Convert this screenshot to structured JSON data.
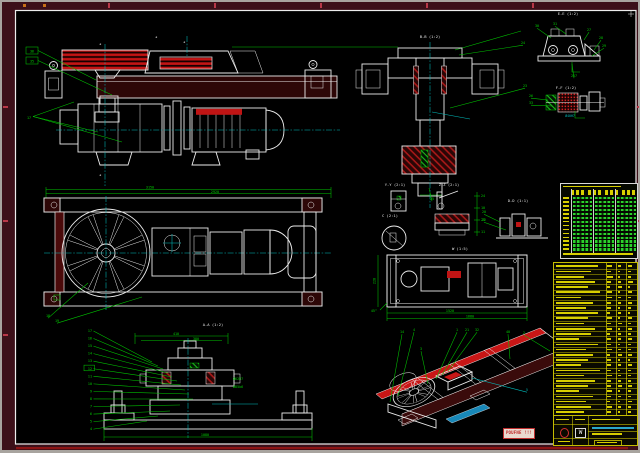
{
  "sheet": {
    "stamp_text": "POUFNE !!!"
  },
  "palette": {
    "margin": "#3c1019",
    "line": "#ececec",
    "dim_green": "#00c400",
    "centerline_cyan": "#00bdbd",
    "hatch_red": "#a81818",
    "bright_red": "#c01414",
    "bom_yellow": "#d8cf00",
    "table_green": "#2bd22b"
  },
  "view_titles": {
    "section_b": "B-B (1:2)",
    "view_e": "E-E (1:2)",
    "section_f": "F-F (1:2)",
    "detail_y": "Y-Y (2:1)",
    "detail_z": "Z-Z (2:1)",
    "detail_c": "C (2:1)",
    "detail_d": "D-D (1:1)",
    "frame_plan": "W (1:5)",
    "assembly_section": "A-A (1:2)"
  },
  "dims": {
    "plan_top_outer": "3150",
    "plan_top_inner": "2920",
    "assembly_top": "410",
    "assembly_top2": "380",
    "assembly_bottom": "1080",
    "assembly_fit1": "Ø62H7",
    "assembly_fit2": "Ø85k6",
    "frame_len_inner": "1520",
    "frame_len_outer": "1680",
    "frame_height": "228",
    "frame_corner": "45°",
    "sectionf_dim": "Ø40H7",
    "detailz_ticks": [
      "24",
      "10",
      "23",
      "11"
    ]
  },
  "callouts": {
    "elevation_left": [
      "36",
      "35",
      "17"
    ],
    "section_b": [
      "24",
      "23",
      "25"
    ],
    "view_e": [
      "30",
      "31",
      "27",
      "28",
      "29",
      "257"
    ],
    "section_f": [
      "26",
      "33"
    ],
    "plan": [
      "18",
      "19"
    ],
    "assembly": [
      "17",
      "16",
      "15",
      "14",
      "13",
      "12",
      "11",
      "10",
      "9",
      "8",
      "7",
      "6",
      "5",
      "4"
    ],
    "assembly_boxed_index": 5,
    "iso": [
      "14",
      "4",
      "1",
      "21",
      "32",
      "40",
      "2",
      "3",
      "5"
    ],
    "detail_d": [
      "20",
      "22"
    ]
  },
  "title_block": {
    "logo_letter": "W"
  },
  "param_table": {
    "rows": 14,
    "groups": 3
  },
  "bom": {
    "rows": [
      [
        0.9,
        0.7,
        0.5,
        0.6
      ],
      [
        0.75,
        0.5,
        0.3,
        0.5
      ],
      [
        0.6,
        0.8,
        0.4,
        0.4
      ],
      [
        0.85,
        0.6,
        0.5,
        0.7
      ],
      [
        0.7,
        0.4,
        0.6,
        0.3
      ],
      [
        0.95,
        0.65,
        0.35,
        0.55
      ],
      [
        0.55,
        0.75,
        0.5,
        0.4
      ],
      [
        0.8,
        0.5,
        0.45,
        0.6
      ],
      [
        0.65,
        0.6,
        0.3,
        0.5
      ],
      [
        0.9,
        0.45,
        0.55,
        0.35
      ],
      [
        0.7,
        0.7,
        0.4,
        0.6
      ],
      [
        0.6,
        0.5,
        0.6,
        0.45
      ],
      [
        0.85,
        0.65,
        0.3,
        0.55
      ],
      [
        0.75,
        0.4,
        0.5,
        0.4
      ],
      [
        0.5,
        0.6,
        0.45,
        0.6
      ],
      [
        0.9,
        0.55,
        0.35,
        0.5
      ],
      [
        0.65,
        0.7,
        0.5,
        0.4
      ],
      [
        0.8,
        0.45,
        0.6,
        0.55
      ],
      [
        0.7,
        0.6,
        0.4,
        0.35
      ],
      [
        0.55,
        0.5,
        0.55,
        0.6
      ],
      [
        0.95,
        0.6,
        0.3,
        0.45
      ],
      [
        0.6,
        0.65,
        0.5,
        0.5
      ],
      [
        0.85,
        0.5,
        0.45,
        0.4
      ],
      [
        0.7,
        0.55,
        0.6,
        0.6
      ],
      [
        0.5,
        0.7,
        0.35,
        0.5
      ],
      [
        0.8,
        0.6,
        0.5,
        0.45
      ],
      [
        0.65,
        0.45,
        0.4,
        0.55
      ],
      [
        0.75,
        0.65,
        0.55,
        0.4
      ],
      [
        0.6,
        0.5,
        0.3,
        0.5
      ]
    ]
  }
}
